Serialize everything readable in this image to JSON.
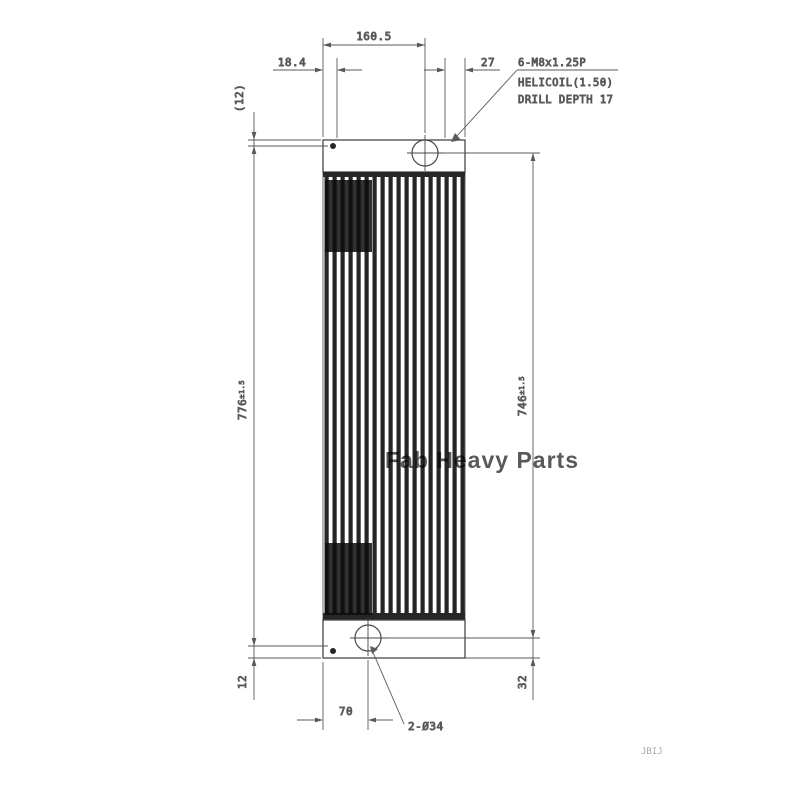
{
  "drawing": {
    "title_semantic": "radiator-core-dimension-drawing",
    "line_color": "#474747",
    "fin_color": "#262626",
    "dims": {
      "top_width": "160.5",
      "top_left_offset": "18.4",
      "top_right_offset": "27",
      "left_ref": "(12)",
      "left_overall": "776",
      "left_overall_tol": "±1.5",
      "left_bottom": "12",
      "right_core": "746",
      "right_core_tol": "±1.5",
      "right_bottom": "32",
      "bottom_offset": "70",
      "holes_label": "2-Ø34"
    },
    "note": {
      "line1": "6-M8x1.25P",
      "line2": "HELICOIL(1.50)",
      "line3": "DRILL DEPTH 17"
    },
    "watermark": {
      "text": "Fab Heavy Parts",
      "color": "#ef9a6a"
    },
    "stamp": "JBIJ"
  }
}
